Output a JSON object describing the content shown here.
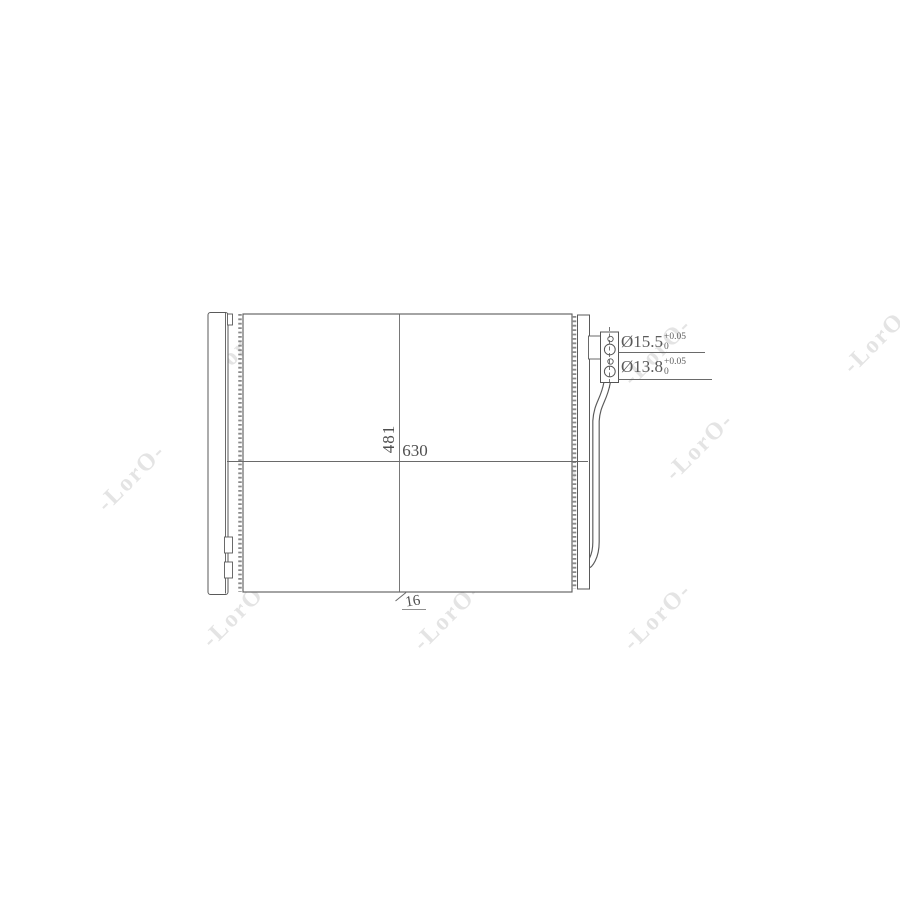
{
  "image": {
    "description": "technical-line-drawing-of-ac-condenser",
    "background_color": "#ffffff",
    "line_color": "#5a5a5a"
  },
  "watermark": {
    "text": "-LorO-",
    "color": "#e4e4e4"
  },
  "drawing": {
    "dim_width": "630",
    "dim_height": "481",
    "dim_depth": "16",
    "ports": [
      {
        "label": "Ø15.5",
        "tol_upper": "+0.05",
        "tol_lower": "0"
      },
      {
        "label": "Ø13.8",
        "tol_upper": "+0.05",
        "tol_lower": "0"
      }
    ]
  }
}
